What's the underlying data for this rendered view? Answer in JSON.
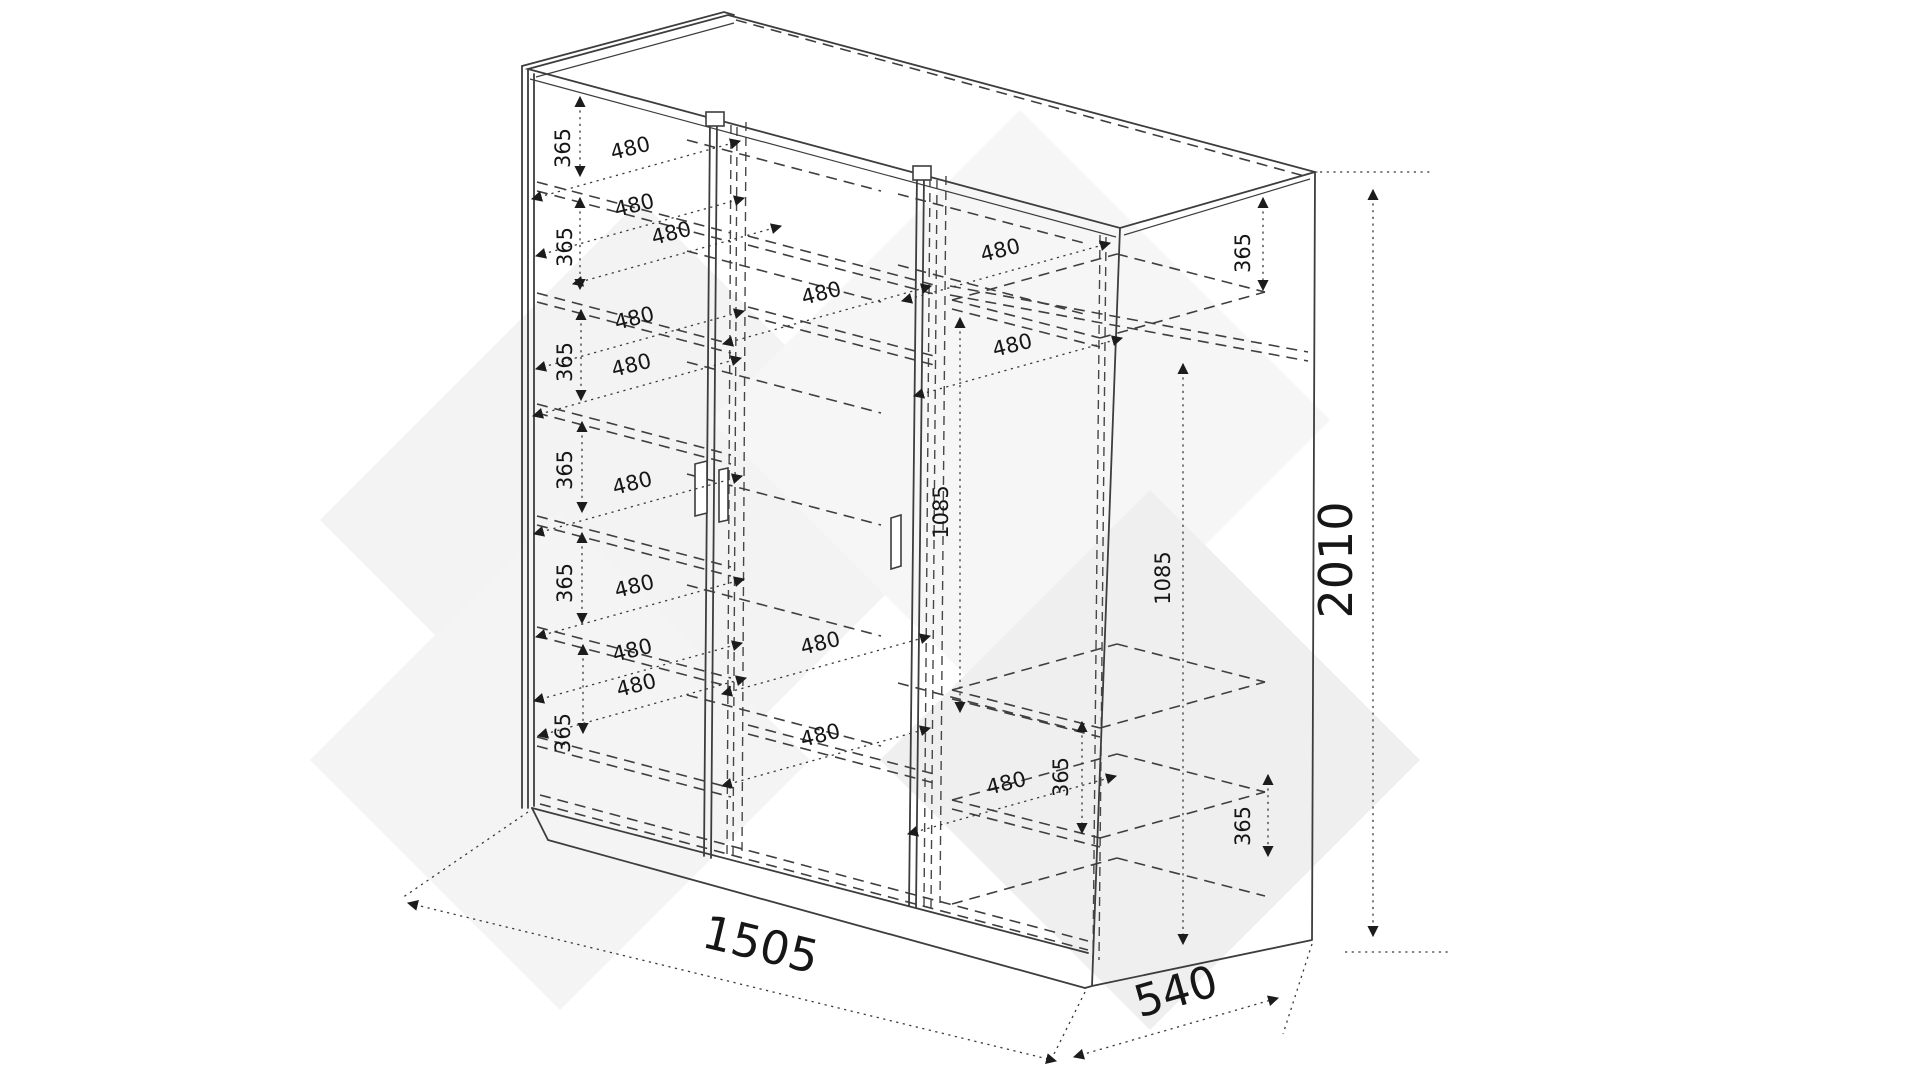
{
  "diagram": {
    "type": "furniture technical drawing",
    "subject": "three-door wardrobe carcass, dimensioned perspective view with hidden shelf lines",
    "units": "mm",
    "overall": {
      "width": "1505",
      "depth": "540",
      "height": "2010"
    },
    "repeated": {
      "shelf_gap": "365",
      "shelf_depth": "480",
      "hanging_height": "1085"
    },
    "colors": {
      "background": "#ffffff",
      "line": "#3d3d3d",
      "dimension_text": "#161616",
      "watermark": "#f1f1f1"
    },
    "labels": [
      {
        "text": "365",
        "x": 570,
        "y": 148,
        "rot": -90,
        "size": 21
      },
      {
        "text": "365",
        "x": 572,
        "y": 247,
        "rot": -90,
        "size": 21
      },
      {
        "text": "365",
        "x": 572,
        "y": 362,
        "rot": -90,
        "size": 21
      },
      {
        "text": "365",
        "x": 572,
        "y": 470,
        "rot": -90,
        "size": 21
      },
      {
        "text": "365",
        "x": 572,
        "y": 583,
        "rot": -90,
        "size": 21
      },
      {
        "text": "365",
        "x": 570,
        "y": 733,
        "rot": -90,
        "size": 21
      },
      {
        "text": "365",
        "x": 1250,
        "y": 253,
        "rot": -90,
        "size": 21
      },
      {
        "text": "365",
        "x": 1068,
        "y": 777,
        "rot": -90,
        "size": 21
      },
      {
        "text": "365",
        "x": 1250,
        "y": 826,
        "rot": -90,
        "size": 21
      },
      {
        "text": "480",
        "x": 632,
        "y": 155,
        "rot": -14,
        "size": 21
      },
      {
        "text": "480",
        "x": 636,
        "y": 212,
        "rot": -14,
        "size": 21
      },
      {
        "text": "480",
        "x": 673,
        "y": 240,
        "rot": -14,
        "size": 21
      },
      {
        "text": "480",
        "x": 1002,
        "y": 257,
        "rot": -14,
        "size": 21
      },
      {
        "text": "480",
        "x": 636,
        "y": 325,
        "rot": -14,
        "size": 21
      },
      {
        "text": "480",
        "x": 823,
        "y": 300,
        "rot": -14,
        "size": 21
      },
      {
        "text": "480",
        "x": 1014,
        "y": 352,
        "rot": -14,
        "size": 21
      },
      {
        "text": "480",
        "x": 633,
        "y": 372,
        "rot": -14,
        "size": 21
      },
      {
        "text": "480",
        "x": 634,
        "y": 490,
        "rot": -14,
        "size": 21
      },
      {
        "text": "480",
        "x": 636,
        "y": 593,
        "rot": -14,
        "size": 21
      },
      {
        "text": "480",
        "x": 634,
        "y": 657,
        "rot": -14,
        "size": 21
      },
      {
        "text": "480",
        "x": 638,
        "y": 692,
        "rot": -14,
        "size": 21
      },
      {
        "text": "480",
        "x": 822,
        "y": 650,
        "rot": -14,
        "size": 21
      },
      {
        "text": "480",
        "x": 822,
        "y": 742,
        "rot": -14,
        "size": 21
      },
      {
        "text": "480",
        "x": 1008,
        "y": 790,
        "rot": -14,
        "size": 21
      },
      {
        "text": "1085",
        "x": 948,
        "y": 512,
        "rot": -90,
        "size": 21
      },
      {
        "text": "1085",
        "x": 1170,
        "y": 578,
        "rot": -90,
        "size": 21
      },
      {
        "text": "2010",
        "x": 1352,
        "y": 560,
        "rot": -90,
        "size": 46
      },
      {
        "text": "1505",
        "x": 757,
        "y": 960,
        "rot": 13.5,
        "size": 46
      },
      {
        "text": "540",
        "x": 1180,
        "y": 1006,
        "rot": -16,
        "size": 44
      }
    ]
  }
}
